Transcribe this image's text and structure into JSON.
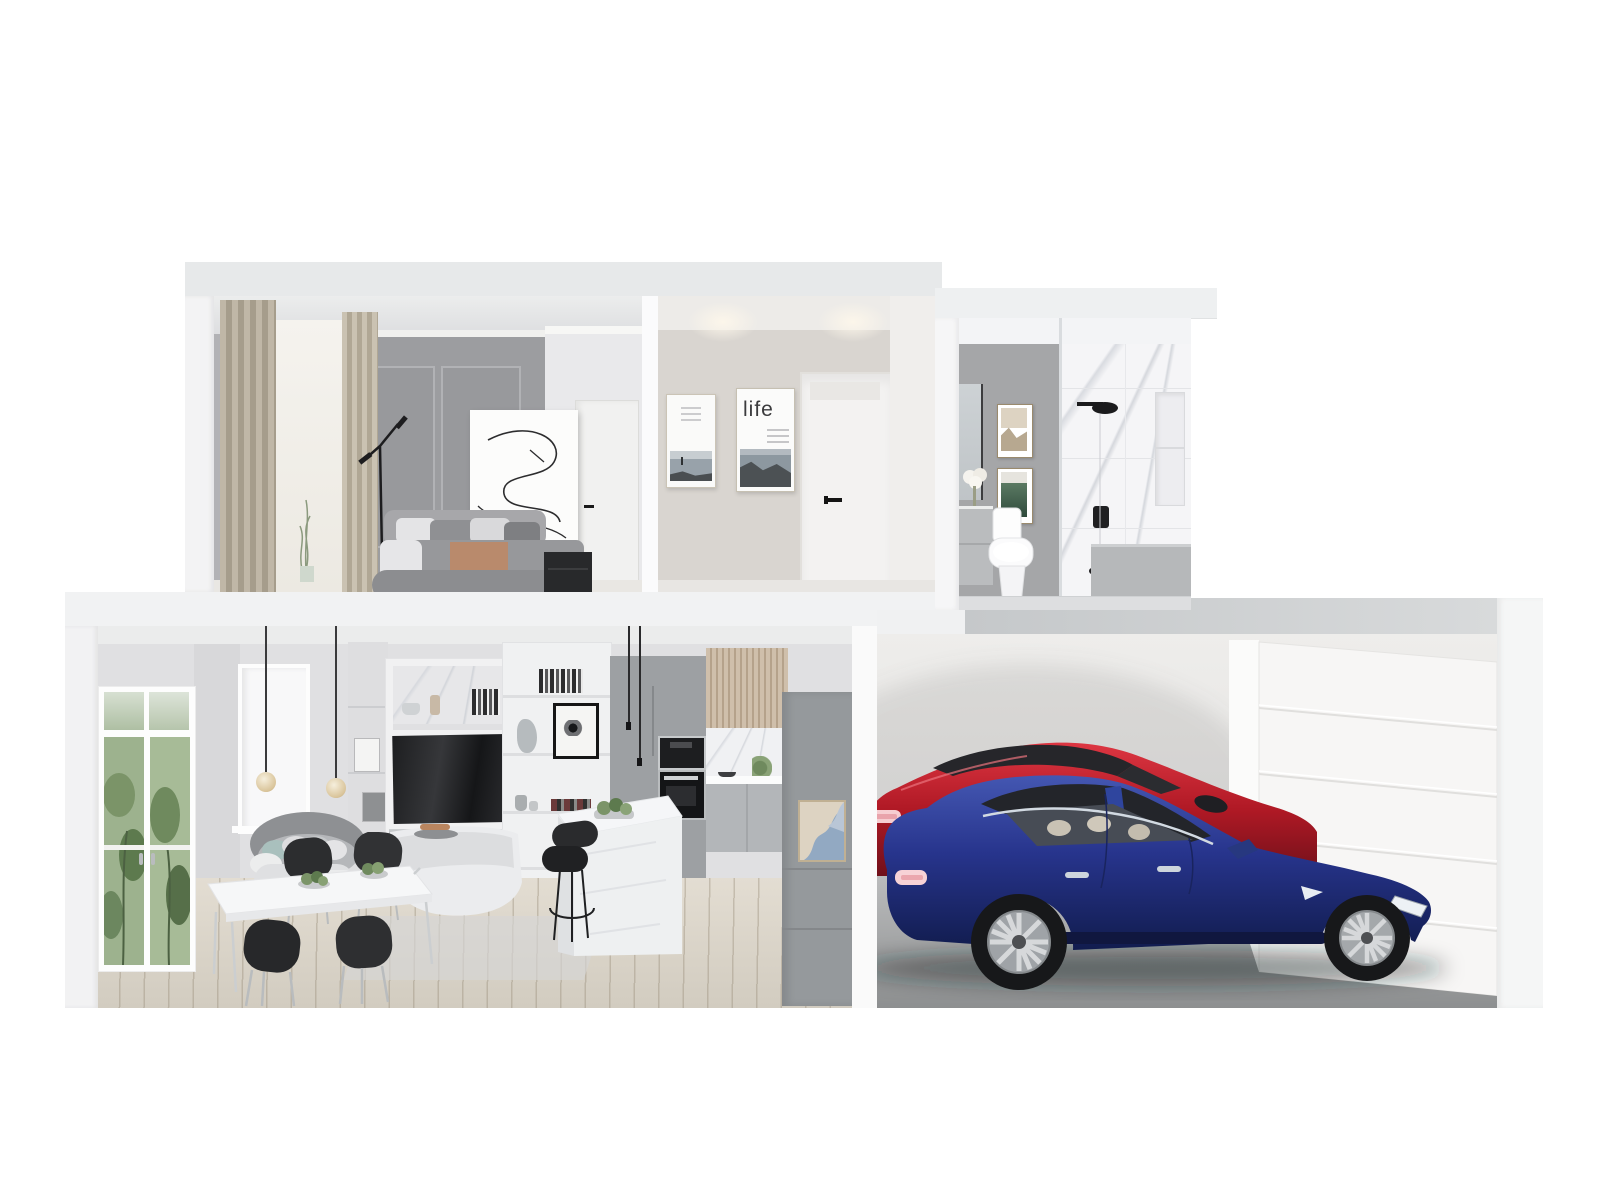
{
  "scene": {
    "type": "architectural-3d-cutaway-render",
    "description": "Dollhouse cross-section rendering of a two-storey home: bedroom, hallway and bathroom upstairs; open-plan living, dining and kitchen plus a two-car garage downstairs.",
    "posters": {
      "life_text": "life"
    },
    "upper_floor": {
      "bedroom": [
        "beige curtains",
        "sheer window",
        "grey panelled wall",
        "abstract line-art headboard panel",
        "grey upholstered bed with pillows and tan throw",
        "black floor lamp",
        "dark nightstand",
        "white door"
      ],
      "hallway": [
        "seascape poster",
        "life poster",
        "white interior door",
        "recessed ceiling lights"
      ],
      "bathroom": [
        "grey feature wall",
        "two framed photos",
        "mirror",
        "vanity with flowers",
        "white toilet",
        "marble shower wall",
        "black shower head",
        "glass screen",
        "wall niche",
        "grey half wall"
      ]
    },
    "lower_floor": {
      "living_dining": [
        "garden-view french doors",
        "bright window",
        "curved grey sofa",
        "white marble dining table",
        "four black dining chairs",
        "two glass pendant lamps",
        "media wall with dark TV",
        "white curved console",
        "styled bookshelf"
      ],
      "kitchen": [
        "grey fridge cabinet",
        "built-in microwave and oven",
        "timber slat upper cabinets",
        "marble backsplash",
        "marble waterfall island",
        "succulent tray",
        "black bar stools",
        "cord pendant lights",
        "grey pantry cabinet with framed abstract art"
      ],
      "garage": [
        "red sedan",
        "blue sedan",
        "white sectional garage door",
        "polished concrete floor"
      ]
    },
    "palette": {
      "background": "#ffffff",
      "slab": "#e7e9ea",
      "bedroom_wall": "#9c9da0",
      "hallway_wall": "#d9d5d0",
      "bathroom_accent_wall": "#a5a6a8",
      "marble": "#f5f5f7",
      "wood_floor": "#dcd6cb",
      "kitchen_cabinet": "#9da0a3",
      "timber_slat": "#c9b9a6",
      "garage_floor": "#9b9d9e",
      "car_blue": "#2b3d91",
      "car_red": "#c1242f",
      "tail_light": "#f7d2d6"
    }
  }
}
